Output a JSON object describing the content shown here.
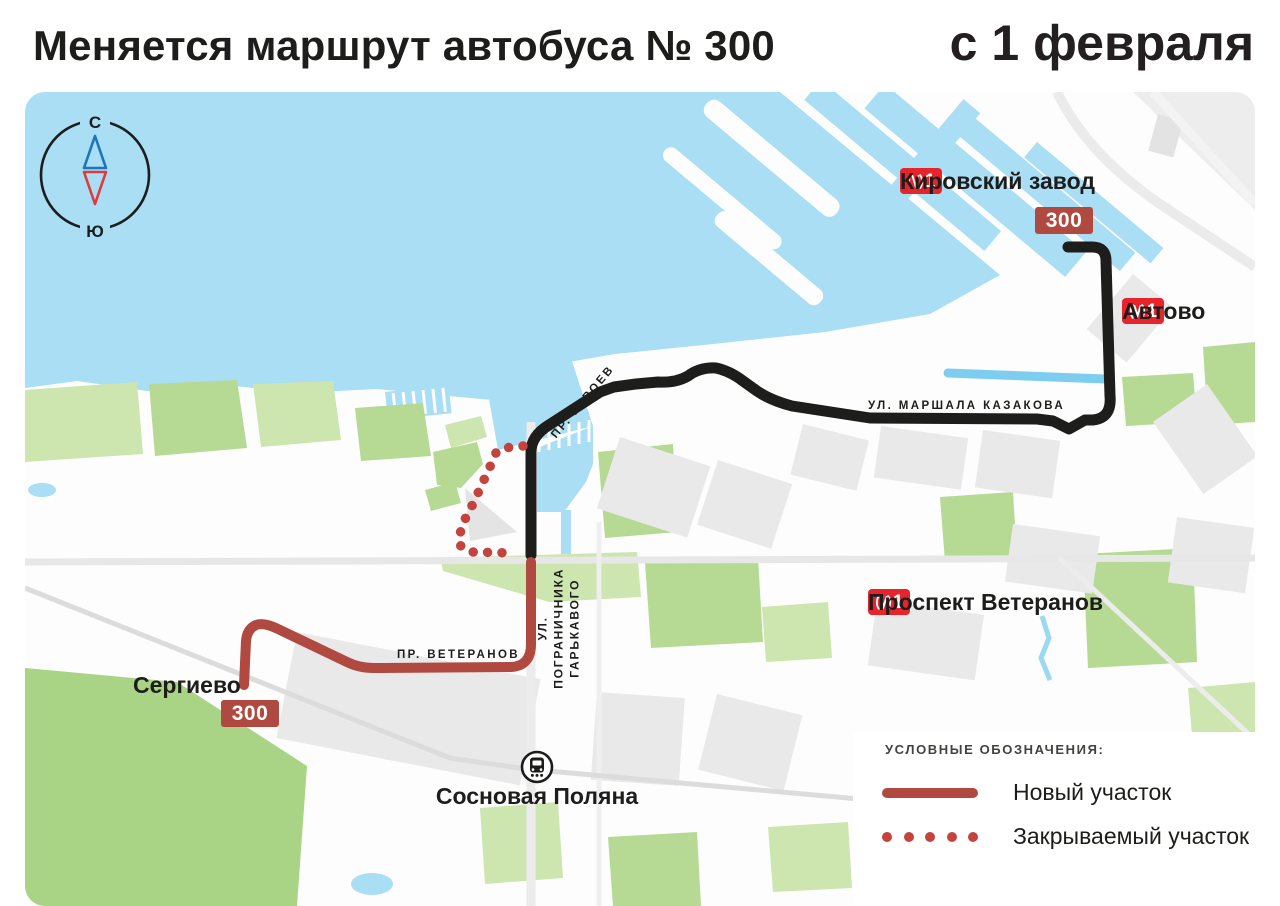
{
  "header": {
    "title": "Меняется маршрут автобуса № 300",
    "effective_date": "с 1 февраля"
  },
  "compass": {
    "north": "С",
    "south": "Ю"
  },
  "route": {
    "number": "300"
  },
  "stations": {
    "kirovsky_zavod": {
      "name": "Кировский завод",
      "metro_line": "1"
    },
    "avtovo": {
      "name": "Автово",
      "metro_line": "1"
    },
    "prospekt_veteranov": {
      "name": "Проспект Ветеранов",
      "metro_line": "1"
    }
  },
  "streets": {
    "marshala_kazakova": "УЛ. МАРШАЛА КАЗАКОВА",
    "geroev": "ПР. ГЕРОЕВ",
    "pogranichnika_line1": "УЛ. ПОГРАНИЧНИКА",
    "pogranichnika_line2": "ГАРЬКАВОГО",
    "veteranov": "ПР. ВЕТЕРАНОВ"
  },
  "places": {
    "sergievo": "Сергиево",
    "sosnovaya_polyana": "Сосновая Поляна"
  },
  "legend": {
    "title": "УСЛОВНЫЕ ОБОЗНАЧЕНИЯ:",
    "items": [
      {
        "label": "Новый участок",
        "style": "solid"
      },
      {
        "label": "Закрываемый участок",
        "style": "dotted"
      }
    ]
  },
  "colors": {
    "route-existing": "#1d1d1b",
    "route-new": "#b0493f",
    "route-closed": "#c2443c",
    "metro-red": "#e7242b",
    "water": "#a9def4",
    "text": "#1d1d1b"
  }
}
